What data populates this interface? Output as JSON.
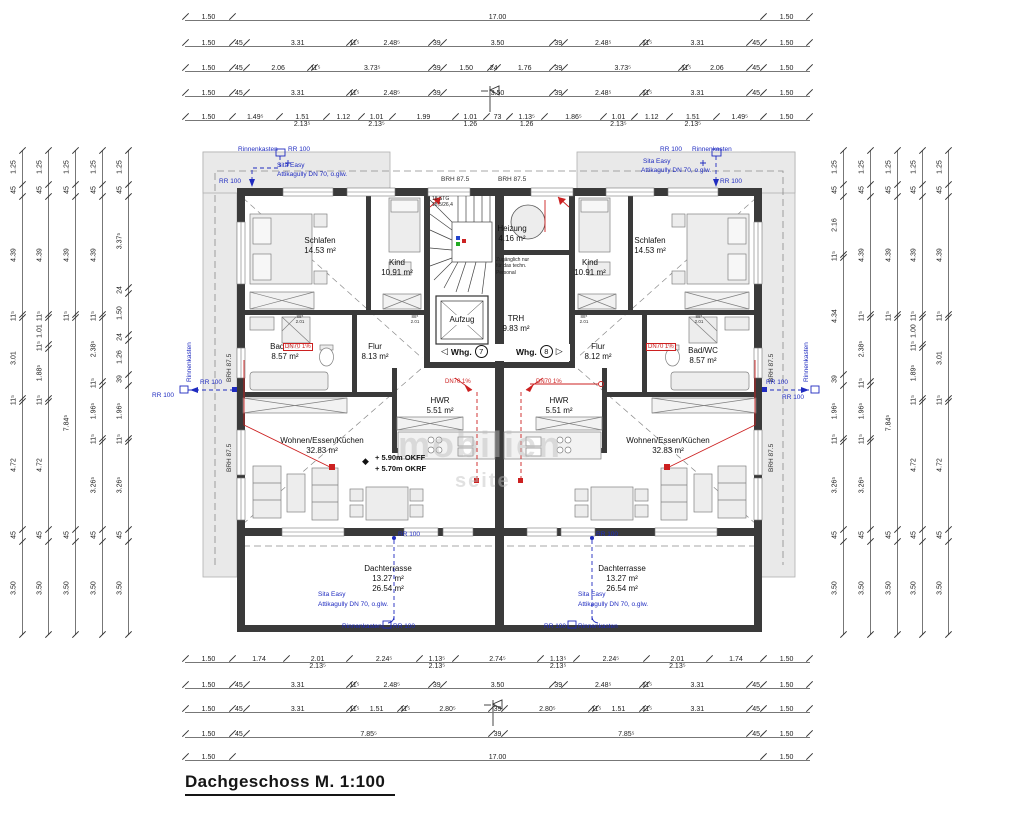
{
  "title": "Dachgeschoss M. 1:100",
  "watermark": {
    "l1": "mobilien",
    "l2": "seite"
  },
  "labels": {
    "rinnenkasten": "Rinnenkasten",
    "rr100": "RR 100",
    "sita": "Sita Easy",
    "attika": "Attikagully DN 70, o.glw.",
    "brh": "BRH 87.5",
    "dn70": "DN70 1%",
    "stairs1": "18 STG",
    "stairs2": "18,5/26,4",
    "zug1": "Zugänglich nur",
    "zug2": "für das techn.",
    "zug3": "Personal",
    "arrow_left": "◁",
    "arrow_right": "▷",
    "whg": "Whg.",
    "whg7_num": "7",
    "whg8_num": "8",
    "elev1": "+ 5.90m OKFF",
    "elev2": "+ 5.70m OKRF",
    "elev_icon": "◆",
    "door_w": "88⁵",
    "door_h": "2.01"
  },
  "rooms": {
    "schlafen_l": {
      "name": "Schlafen",
      "area": "14.53 m²"
    },
    "kind_l": {
      "name": "Kind",
      "area": "10.91 m²"
    },
    "bad_l": {
      "name": "Bad/WC",
      "area": "8.57 m²"
    },
    "flur_l": {
      "name": "Flur",
      "area": "8.13 m²"
    },
    "wohnen_l": {
      "name": "Wohnen/Essen/Küchen",
      "area": "32.83 m²"
    },
    "hwr_l": {
      "name": "HWR",
      "area": "5.51 m²"
    },
    "terrasse_l": {
      "name": "Dachterrasse",
      "area": "13.27 m²",
      "area2": "26.54 m²"
    },
    "schlafen_r": {
      "name": "Schlafen",
      "area": "14.53 m²"
    },
    "kind_r": {
      "name": "Kind",
      "area": "10.91 m²"
    },
    "bad_r": {
      "name": "Bad/WC",
      "area": "8.57 m²"
    },
    "flur_r": {
      "name": "Flur",
      "area": "8.12 m²"
    },
    "wohnen_r": {
      "name": "Wohnen/Essen/Küchen",
      "area": "32.83 m²"
    },
    "hwr_r": {
      "name": "HWR",
      "area": "5.51 m²"
    },
    "terrasse_r": {
      "name": "Dachterrasse",
      "area": "13.27 m²",
      "area2": "26.54 m²"
    },
    "heizung": {
      "name": "Heizung",
      "area": "4.16 m²"
    },
    "trh": {
      "name": "TRH",
      "area": "9.83 m²"
    },
    "aufzug": {
      "name": "Aufzug"
    }
  },
  "dims": {
    "top": [
      [
        {
          "t": "1.50",
          "w": 1.5
        },
        {
          "t": "17.00",
          "w": 17
        },
        {
          "t": "1.50",
          "w": 1.5
        }
      ],
      [
        {
          "t": "1.50",
          "w": 1.5
        },
        {
          "t": "45",
          "w": 0.45
        },
        {
          "t": "3.31",
          "w": 3.31
        },
        {
          "t": "11⁵",
          "w": 0.115
        },
        {
          "t": "2.48⁵",
          "w": 2.485
        },
        {
          "t": "39",
          "w": 0.39
        },
        {
          "t": "3.50",
          "w": 3.5
        },
        {
          "t": "39",
          "w": 0.39
        },
        {
          "t": "2.48⁵",
          "w": 2.485
        },
        {
          "t": "11⁵",
          "w": 0.115
        },
        {
          "t": "3.31",
          "w": 3.31
        },
        {
          "t": "45",
          "w": 0.45
        },
        {
          "t": "1.50",
          "w": 1.5
        }
      ],
      [
        {
          "t": "1.50",
          "w": 1.5
        },
        {
          "t": "45",
          "w": 0.45
        },
        {
          "t": "2.06",
          "w": 2.06
        },
        {
          "t": "11⁵",
          "w": 0.115
        },
        {
          "t": "3.73⁵",
          "w": 3.735
        },
        {
          "t": "39",
          "w": 0.39
        },
        {
          "t": "1.50",
          "w": 1.5
        },
        {
          "t": "24",
          "w": 0.24
        },
        {
          "t": "1.76",
          "w": 1.76
        },
        {
          "t": "39",
          "w": 0.39
        },
        {
          "t": "3.73⁵",
          "w": 3.735
        },
        {
          "t": "11⁵",
          "w": 0.115
        },
        {
          "t": "2.06",
          "w": 2.06
        },
        {
          "t": "45",
          "w": 0.45
        },
        {
          "t": "1.50",
          "w": 1.5
        }
      ],
      [
        {
          "t": "1.50",
          "w": 1.5
        },
        {
          "t": "45",
          "w": 0.45
        },
        {
          "t": "3.31",
          "w": 3.31
        },
        {
          "t": "11⁵",
          "w": 0.115
        },
        {
          "t": "2.48⁵",
          "w": 2.485
        },
        {
          "t": "39",
          "w": 0.39
        },
        {
          "t": "3.50",
          "w": 3.5
        },
        {
          "t": "39",
          "w": 0.39
        },
        {
          "t": "2.48⁵",
          "w": 2.485
        },
        {
          "t": "11⁵",
          "w": 0.115
        },
        {
          "t": "3.31",
          "w": 3.31
        },
        {
          "t": "45",
          "w": 0.45
        },
        {
          "t": "1.50",
          "w": 1.5
        }
      ],
      [
        {
          "t": "1.50",
          "w": 1.5
        },
        {
          "t": "1.49⁵",
          "w": 1.495
        },
        {
          "t": "1.51",
          "w": 1.51,
          "s": "2.13⁵"
        },
        {
          "t": "1.12",
          "w": 1.12
        },
        {
          "t": "1.01",
          "w": 1.01,
          "s": "2.13⁵"
        },
        {
          "t": "1.99",
          "w": 1.99
        },
        {
          "t": "1.01",
          "w": 1.01,
          "s": "1.26"
        },
        {
          "t": "73",
          "w": 0.73
        },
        {
          "t": "1.13⁵",
          "w": 1.135,
          "s": "1.26"
        },
        {
          "t": "1.86⁵",
          "w": 1.865
        },
        {
          "t": "1.01",
          "w": 1.01,
          "s": "2.13⁵"
        },
        {
          "t": "1.12",
          "w": 1.12
        },
        {
          "t": "1.51",
          "w": 1.51,
          "s": "2.13⁵"
        },
        {
          "t": "1.49⁵",
          "w": 1.495
        },
        {
          "t": "1.50",
          "w": 1.5
        }
      ]
    ],
    "bottom": [
      [
        {
          "t": "1.50",
          "w": 1.5
        },
        {
          "t": "1.74",
          "w": 1.74
        },
        {
          "t": "2.01",
          "w": 2.01,
          "s": "2.13⁵"
        },
        {
          "t": "2.24⁵",
          "w": 2.245
        },
        {
          "t": "1.13⁵",
          "w": 1.135,
          "s": "2.13⁵"
        },
        {
          "t": "2.74⁵",
          "w": 2.745
        },
        {
          "t": "1.13⁵",
          "w": 1.135,
          "s": "2.13⁵"
        },
        {
          "t": "2.24⁵",
          "w": 2.245
        },
        {
          "t": "2.01",
          "w": 2.01,
          "s": "2.13⁵"
        },
        {
          "t": "1.74",
          "w": 1.74
        },
        {
          "t": "1.50",
          "w": 1.5
        }
      ],
      [
        {
          "t": "1.50",
          "w": 1.5
        },
        {
          "t": "45",
          "w": 0.45
        },
        {
          "t": "3.31",
          "w": 3.31
        },
        {
          "t": "11⁵",
          "w": 0.115
        },
        {
          "t": "2.48⁵",
          "w": 2.485
        },
        {
          "t": "39",
          "w": 0.39
        },
        {
          "t": "3.50",
          "w": 3.5
        },
        {
          "t": "39",
          "w": 0.39
        },
        {
          "t": "2.48⁵",
          "w": 2.485
        },
        {
          "t": "11⁵",
          "w": 0.115
        },
        {
          "t": "3.31",
          "w": 3.31
        },
        {
          "t": "45",
          "w": 0.45
        },
        {
          "t": "1.50",
          "w": 1.5
        }
      ],
      [
        {
          "t": "1.50",
          "w": 1.5
        },
        {
          "t": "45",
          "w": 0.45
        },
        {
          "t": "3.31",
          "w": 3.31
        },
        {
          "t": "11⁵",
          "w": 0.115
        },
        {
          "t": "1.51",
          "w": 1.51
        },
        {
          "t": "11⁵",
          "w": 0.115
        },
        {
          "t": "2.80⁵",
          "w": 2.805
        },
        {
          "t": "39",
          "w": 0.39
        },
        {
          "t": "2.80⁵",
          "w": 2.805
        },
        {
          "t": "11⁵",
          "w": 0.115
        },
        {
          "t": "1.51",
          "w": 1.51
        },
        {
          "t": "11⁵",
          "w": 0.115
        },
        {
          "t": "3.31",
          "w": 3.31
        },
        {
          "t": "45",
          "w": 0.45
        },
        {
          "t": "1.50",
          "w": 1.5
        }
      ],
      [
        {
          "t": "1.50",
          "w": 1.5
        },
        {
          "t": "45",
          "w": 0.45
        },
        {
          "t": "7.85⁵",
          "w": 7.855
        },
        {
          "t": "39",
          "w": 0.39
        },
        {
          "t": "7.85⁵",
          "w": 7.855
        },
        {
          "t": "45",
          "w": 0.45
        },
        {
          "t": "1.50",
          "w": 1.5
        }
      ],
      [
        {
          "t": "1.50",
          "w": 1.5
        },
        {
          "t": "17.00",
          "w": 17
        },
        {
          "t": "1.50",
          "w": 1.5
        }
      ]
    ],
    "left": [
      [
        {
          "t": "1.25",
          "w": 1.25
        },
        {
          "t": "45",
          "w": 0.45
        },
        {
          "t": "4.39",
          "w": 4.39
        },
        {
          "t": "11⁵",
          "w": 0.115
        },
        {
          "t": "3.01",
          "w": 3.01
        },
        {
          "t": "11⁵",
          "w": 0.115
        },
        {
          "t": "4.72",
          "w": 4.72
        },
        {
          "t": "45",
          "w": 0.45
        },
        {
          "t": "3.50",
          "w": 3.5
        }
      ],
      [
        {
          "t": "1.25",
          "w": 1.25
        },
        {
          "t": "45",
          "w": 0.45
        },
        {
          "t": "4.39",
          "w": 4.39
        },
        {
          "t": "11⁵",
          "w": 0.115
        },
        {
          "t": "1.01",
          "w": 1.01
        },
        {
          "t": "11⁵",
          "w": 0.115
        },
        {
          "t": "1.88⁵",
          "w": 1.885
        },
        {
          "t": "11⁵",
          "w": 0.115
        },
        {
          "t": "4.72",
          "w": 4.72
        },
        {
          "t": "45",
          "w": 0.45
        },
        {
          "t": "3.50",
          "w": 3.5
        }
      ],
      [
        {
          "t": "1.25",
          "w": 1.25
        },
        {
          "t": "45",
          "w": 0.45
        },
        {
          "t": "4.39",
          "w": 4.39
        },
        {
          "t": "11⁵",
          "w": 0.115
        },
        {
          "t": "7.84⁵",
          "w": 7.845
        },
        {
          "t": "45",
          "w": 0.45
        },
        {
          "t": "3.50",
          "w": 3.5
        }
      ],
      [
        {
          "t": "1.25",
          "w": 1.25
        },
        {
          "t": "45",
          "w": 0.45
        },
        {
          "t": "4.39",
          "w": 4.39
        },
        {
          "t": "11⁵",
          "w": 0.115
        },
        {
          "t": "2.38⁵",
          "w": 2.385
        },
        {
          "t": "11⁵",
          "w": 0.115
        },
        {
          "t": "1.96⁵",
          "w": 1.965
        },
        {
          "t": "11⁵",
          "w": 0.115
        },
        {
          "t": "3.26⁵",
          "w": 3.265
        },
        {
          "t": "45",
          "w": 0.45
        },
        {
          "t": "3.50",
          "w": 3.5
        }
      ],
      [
        {
          "t": "1.25",
          "w": 1.25
        },
        {
          "t": "45",
          "w": 0.45
        },
        {
          "t": "3.37⁵",
          "w": 3.375
        },
        {
          "t": "24",
          "w": 0.24
        },
        {
          "t": "1.50",
          "w": 1.5
        },
        {
          "t": "24",
          "w": 0.24
        },
        {
          "t": "1.26",
          "w": 1.26
        },
        {
          "t": "39",
          "w": 0.39
        },
        {
          "t": "1.96⁵",
          "w": 1.965
        },
        {
          "t": "11⁵",
          "w": 0.115
        },
        {
          "t": "3.26⁵",
          "w": 3.265
        },
        {
          "t": "45",
          "w": 0.45
        },
        {
          "t": "3.50",
          "w": 3.5
        }
      ]
    ],
    "right": [
      [
        {
          "t": "1.25",
          "w": 1.25
        },
        {
          "t": "45",
          "w": 0.45
        },
        {
          "t": "2.16",
          "w": 2.16
        },
        {
          "t": "11⁵",
          "w": 0.115
        },
        {
          "t": "4.34",
          "w": 4.34
        },
        {
          "t": "39",
          "w": 0.39
        },
        {
          "t": "1.96⁵",
          "w": 1.965
        },
        {
          "t": "11⁵",
          "w": 0.115
        },
        {
          "t": "3.26⁵",
          "w": 3.265
        },
        {
          "t": "45",
          "w": 0.45
        },
        {
          "t": "3.50",
          "w": 3.5
        }
      ],
      [
        {
          "t": "1.25",
          "w": 1.25
        },
        {
          "t": "45",
          "w": 0.45
        },
        {
          "t": "4.39",
          "w": 4.39
        },
        {
          "t": "11⁵",
          "w": 0.115
        },
        {
          "t": "2.38⁵",
          "w": 2.385
        },
        {
          "t": "11⁵",
          "w": 0.115
        },
        {
          "t": "1.96⁵",
          "w": 1.965
        },
        {
          "t": "11⁵",
          "w": 0.115
        },
        {
          "t": "3.26⁵",
          "w": 3.265
        },
        {
          "t": "45",
          "w": 0.45
        },
        {
          "t": "3.50",
          "w": 3.5
        }
      ],
      [
        {
          "t": "1.25",
          "w": 1.25
        },
        {
          "t": "45",
          "w": 0.45
        },
        {
          "t": "4.39",
          "w": 4.39
        },
        {
          "t": "11⁵",
          "w": 0.115
        },
        {
          "t": "7.84⁵",
          "w": 7.845
        },
        {
          "t": "45",
          "w": 0.45
        },
        {
          "t": "3.50",
          "w": 3.5
        }
      ],
      [
        {
          "t": "1.25",
          "w": 1.25
        },
        {
          "t": "45",
          "w": 0.45
        },
        {
          "t": "4.39",
          "w": 4.39
        },
        {
          "t": "11⁵",
          "w": 0.115
        },
        {
          "t": "1.00",
          "w": 1.0
        },
        {
          "t": "11⁵",
          "w": 0.115
        },
        {
          "t": "1.89⁵",
          "w": 1.895
        },
        {
          "t": "11⁵",
          "w": 0.115
        },
        {
          "t": "4.72",
          "w": 4.72
        },
        {
          "t": "45",
          "w": 0.45
        },
        {
          "t": "3.50",
          "w": 3.5
        }
      ],
      [
        {
          "t": "1.25",
          "w": 1.25
        },
        {
          "t": "45",
          "w": 0.45
        },
        {
          "t": "4.39",
          "w": 4.39
        },
        {
          "t": "11⁵",
          "w": 0.115
        },
        {
          "t": "3.01",
          "w": 3.01
        },
        {
          "t": "11⁵",
          "w": 0.115
        },
        {
          "t": "4.72",
          "w": 4.72
        },
        {
          "t": "45",
          "w": 0.45
        },
        {
          "t": "3.50",
          "w": 3.5
        }
      ]
    ]
  }
}
